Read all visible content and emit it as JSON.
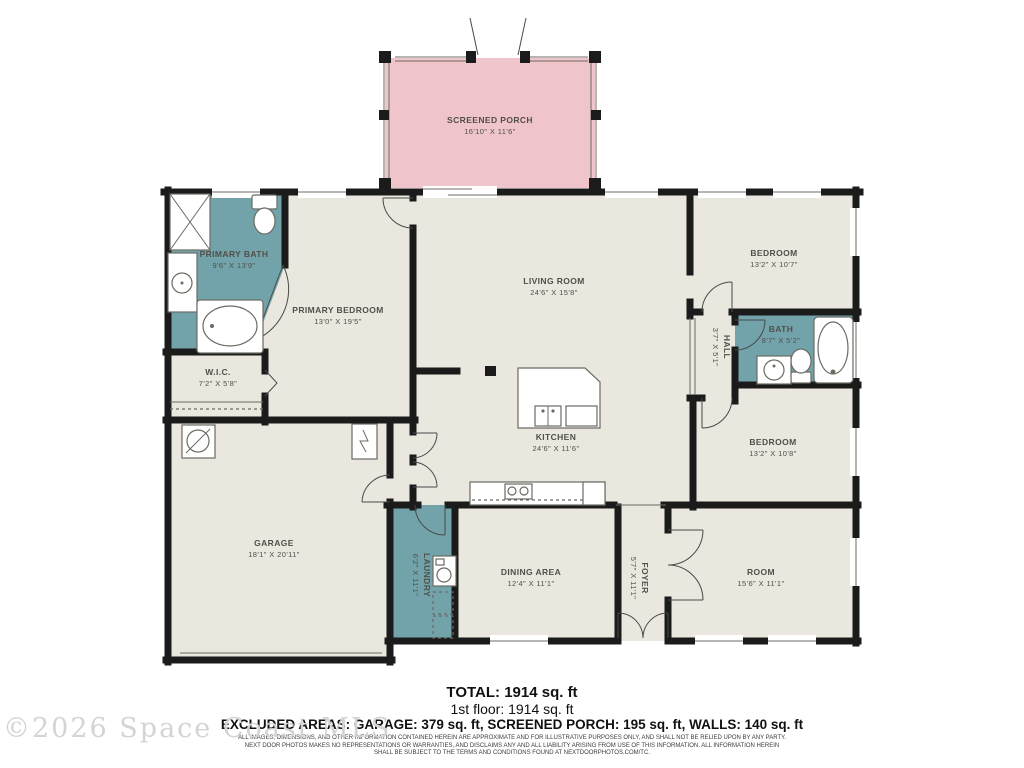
{
  "colors": {
    "wall": "#1b1b1b",
    "floor": "#e9e7de",
    "wet": "#72a3ab",
    "porch": "#efc4ca"
  },
  "rooms": [
    {
      "name": "SCREENED PORCH",
      "dims": "16'10\" X 11'6\""
    },
    {
      "name": "PRIMARY BATH",
      "dims": "9'6\" X 13'9\""
    },
    {
      "name": "PRIMARY BEDROOM",
      "dims": "13'0\" X 19'5\""
    },
    {
      "name": "LIVING ROOM",
      "dims": "24'6\" X 15'8\""
    },
    {
      "name": "BEDROOM",
      "dims": "13'2\" X 10'7\""
    },
    {
      "name": "BATH",
      "dims": "8'7\" X 5'2\""
    },
    {
      "name": "HALL",
      "dims": "3'7\" X 5'1\""
    },
    {
      "name": "W.I.C.",
      "dims": "7'2\" X 5'8\""
    },
    {
      "name": "KITCHEN",
      "dims": "24'6\" X 11'6\""
    },
    {
      "name": "BEDROOM",
      "dims": "13'2\" X 10'8\""
    },
    {
      "name": "GARAGE",
      "dims": "18'1\" X 20'11\""
    },
    {
      "name": "LAUNDRY",
      "dims": "6'2\" X 11'1\""
    },
    {
      "name": "DINING AREA",
      "dims": "12'4\" X 11'1\""
    },
    {
      "name": "FOYER",
      "dims": "5'7\" X 11'1\""
    },
    {
      "name": "ROOM",
      "dims": "15'6\" X 11'1\""
    }
  ],
  "summary": {
    "total": "TOTAL: 1914 sq. ft",
    "floor1": "1st floor: 1914 sq. ft",
    "excluded": "EXCLUDED AREAS: GARAGE: 379 sq. ft, SCREENED PORCH: 195 sq. ft, WALLS: 140 sq. ft"
  },
  "disclaimer": {
    "line1": "ALL IMAGES, DIMENSIONS, AND OTHER INFORMATION CONTAINED HEREIN ARE APPROXIMATE AND FOR ILLUSTRATIVE PURPOSES ONLY, AND SHALL NOT BE RELIED UPON BY ANY PARTY.",
    "line2": "NEXT DOOR PHOTOS MAKES NO REPRESENTATIONS OR WARRANTIES, AND DISCLAIMS ANY AND ALL LIABILITY ARISING FROM USE OF THIS INFORMATION. ALL INFORMATION HEREIN",
    "line3": "SHALL BE SUBJECT TO THE TERMS AND CONDITIONS FOUND AT NEXTDOORPHOTOS.COM/TC."
  },
  "watermark": "©2026 Space Coast MLS"
}
